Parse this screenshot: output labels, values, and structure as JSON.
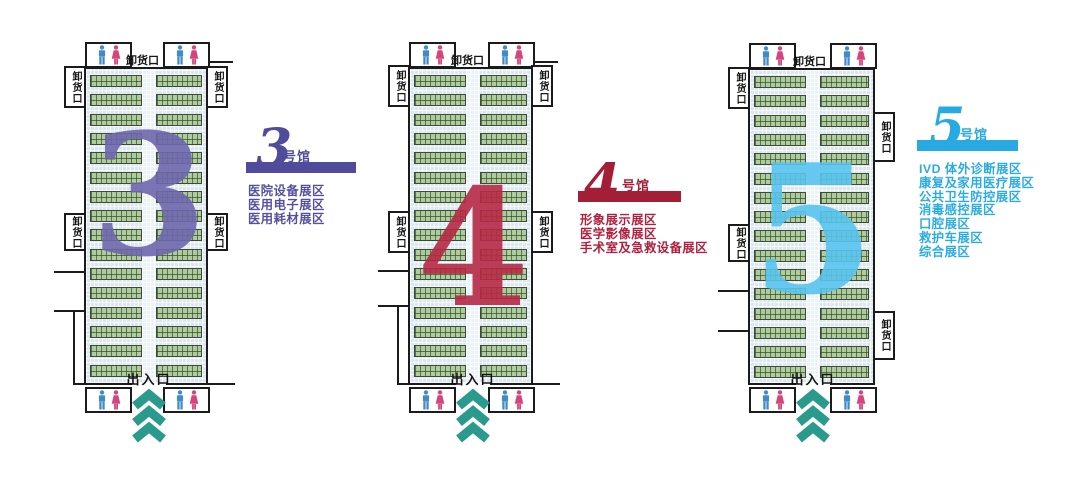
{
  "palette": {
    "wall": "#1b1b1b",
    "booth_fill": "#aecb9b",
    "floor": "#dbe7f0",
    "aisle": "#e9f2f8",
    "chevron": "#2a9a8c",
    "male_icon": "#418bc7",
    "female_icon": "#d6447c"
  },
  "halls": [
    {
      "id": "3",
      "number": "3",
      "colors": {
        "number": "#6e67ad",
        "banner": "#504c9b",
        "text": "#55509e"
      },
      "labels": {
        "top_dock": "卸货口",
        "dock": "卸货口",
        "entrance": "出入口"
      },
      "legend": {
        "number": "3",
        "suffix": "号馆",
        "items": [
          "医院设备展区",
          "医用电子展区",
          "医用耗材展区"
        ]
      }
    },
    {
      "id": "4",
      "number": "4",
      "colors": {
        "number": "#b62945",
        "banner": "#a31f37",
        "text": "#b0203e"
      },
      "labels": {
        "top_dock": "卸货口",
        "dock": "卸货口",
        "entrance": "出入口"
      },
      "legend": {
        "number": "4",
        "suffix": "号馆",
        "items": [
          "形象展示展区",
          "医学影像展区",
          "手术室及急救设备展区"
        ]
      }
    },
    {
      "id": "5",
      "number": "5",
      "colors": {
        "number": "#58c4ef",
        "banner": "#29a9e1",
        "text": "#2aabe2"
      },
      "labels": {
        "top_dock": "卸货口",
        "dock": "卸货口",
        "entrance": "出入口"
      },
      "legend": {
        "number": "5",
        "suffix": "号馆",
        "items": [
          "IVD 体外诊断展区",
          "康复及家用医疗展区",
          "公共卫生防控展区",
          "消毒感控展区",
          "口腔展区",
          "救护车展区",
          "综合展区"
        ]
      }
    }
  ]
}
